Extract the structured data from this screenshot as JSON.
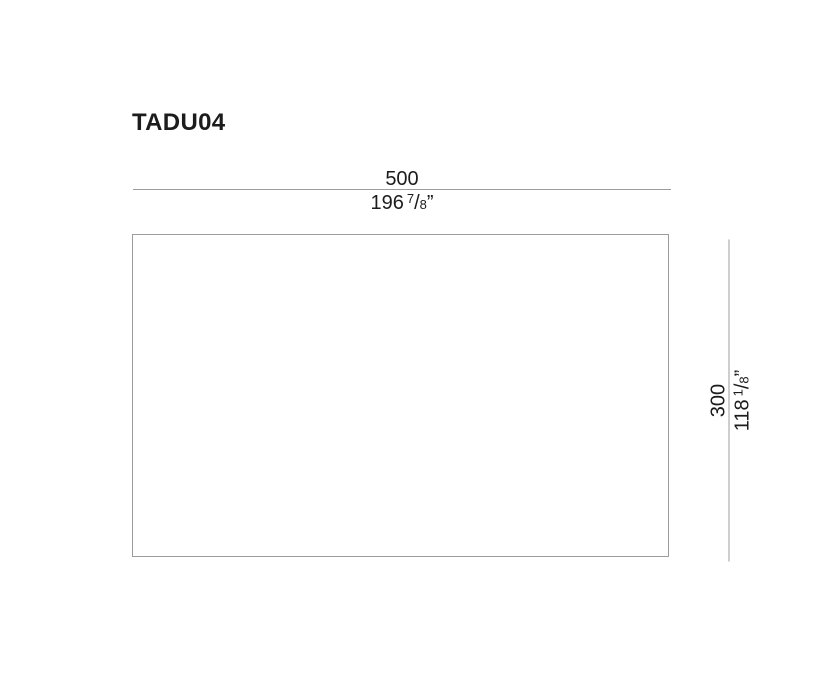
{
  "title": "TADU04",
  "diagram": {
    "shape": "rectangle-outline",
    "width_dimension": {
      "mm": "500",
      "in_whole": "196",
      "frac_num": "7",
      "frac_slash": "/",
      "frac_den": "8",
      "unit_mark": "”"
    },
    "height_dimension": {
      "mm": "300",
      "in_whole": "118",
      "frac_num": "1",
      "frac_slash": "/",
      "frac_den": "8",
      "unit_mark": "”"
    }
  },
  "colors": {
    "background": "#ffffff",
    "text": "#1c1c1c",
    "line": "#9c9c9c"
  }
}
